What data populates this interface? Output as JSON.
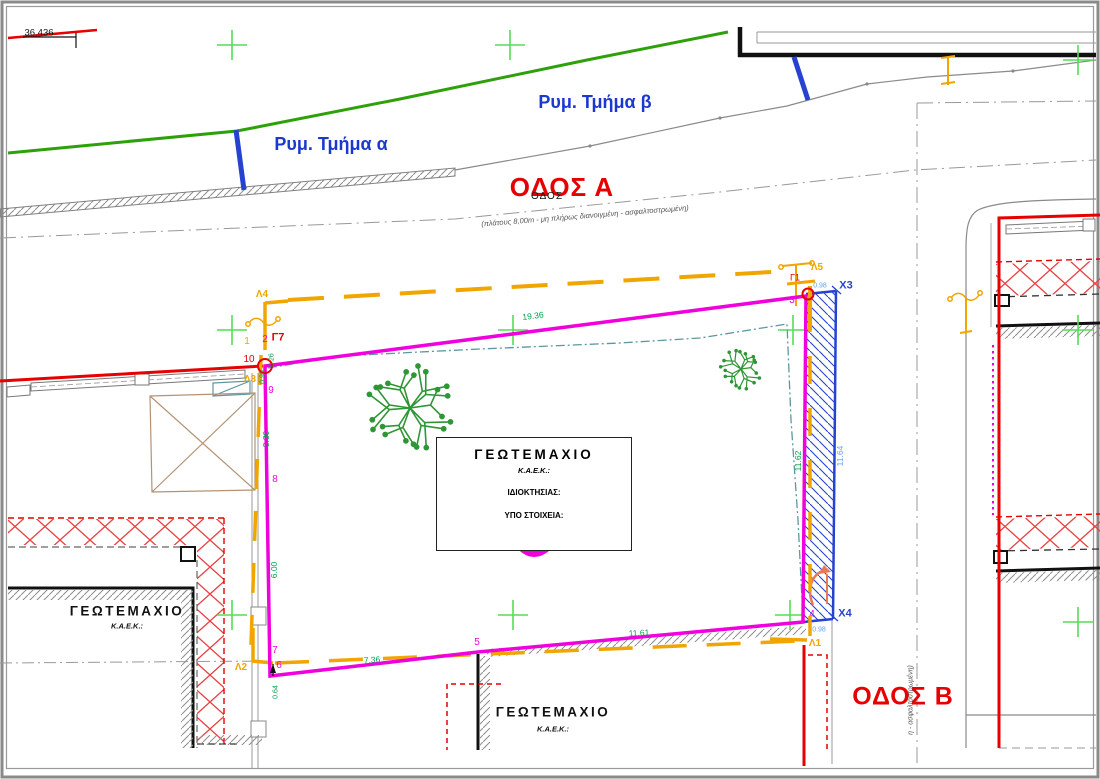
{
  "streets": {
    "odos_a": "ΟΔΟΣ Α",
    "odos_a_sub": "ΟΔΟΣ",
    "odos_a_note": "(πλάτους 8,00m - μη πλήρως διανοιγμένη - ασφαλτοστρωμένη)",
    "odos_b": "ΟΔΟΣ Β",
    "odos_b_note": "η - ασφαλτοστρωμένη)",
    "rym_tmima_a": "Ρυμ. Τμήμα α",
    "rym_tmima_b": "Ρυμ. Τμήμα β"
  },
  "elevation": "36.436",
  "main_parcel": {
    "title": "ΓΕΩΤΕΜΑΧΙΟ",
    "kaek_label": "Κ.Α.Ε.Κ.:",
    "owner_label": "ΙΔΙΟΚΤΗΣΙΑΣ:",
    "elements_label": "ΥΠΟ ΣΤΟΙΧΕΙΑ:"
  },
  "neighbor_parcel_left": {
    "title": "ΓΕΩΤΕΜΑΧΙΟ",
    "kaek_label": "Κ.Α.Ε.Κ.:"
  },
  "neighbor_parcel_bottom": {
    "title": "ΓΕΩΤΕΜΑΧΙΟ",
    "kaek_label": "Κ.Α.Ε.Κ.:"
  },
  "points": {
    "p1": "1",
    "p2": "2",
    "p3": "3",
    "p4": "4",
    "p5": "5",
    "p6": "6",
    "p7": "7",
    "p8": "8",
    "p9": "9",
    "p10": "10",
    "g7": "Γ7",
    "g1": "Γ1",
    "l1": "Λ1",
    "l2": "Λ2",
    "l3": "Λ3",
    "l4": "Λ4",
    "l5": "Λ5",
    "x3": "X3",
    "x4": "X4"
  },
  "dimensions": {
    "top": "19.36",
    "right_inner": "11.62",
    "right_outer": "11.64",
    "bottom_right": "11.61",
    "bottom_left": "7.36",
    "left_upper": "3.30",
    "left_lower": "6.00",
    "bottom_corner": "0.64",
    "corner_a": "0.96",
    "corner_b": "0.26",
    "x3_offset": "0.98",
    "x4_offset": "0.98"
  },
  "colors": {
    "boundary_magenta": "#f000dd",
    "offset_orange": "#f0a500",
    "sidewalk_blue": "#2543d0",
    "dim_green": "#00a14b",
    "dim_cyan": "#5ba3f5",
    "street_red": "#e60000",
    "label_blue": "#1c39cf",
    "tree_green": "#2f9635",
    "cross_green": "#55dd55"
  }
}
